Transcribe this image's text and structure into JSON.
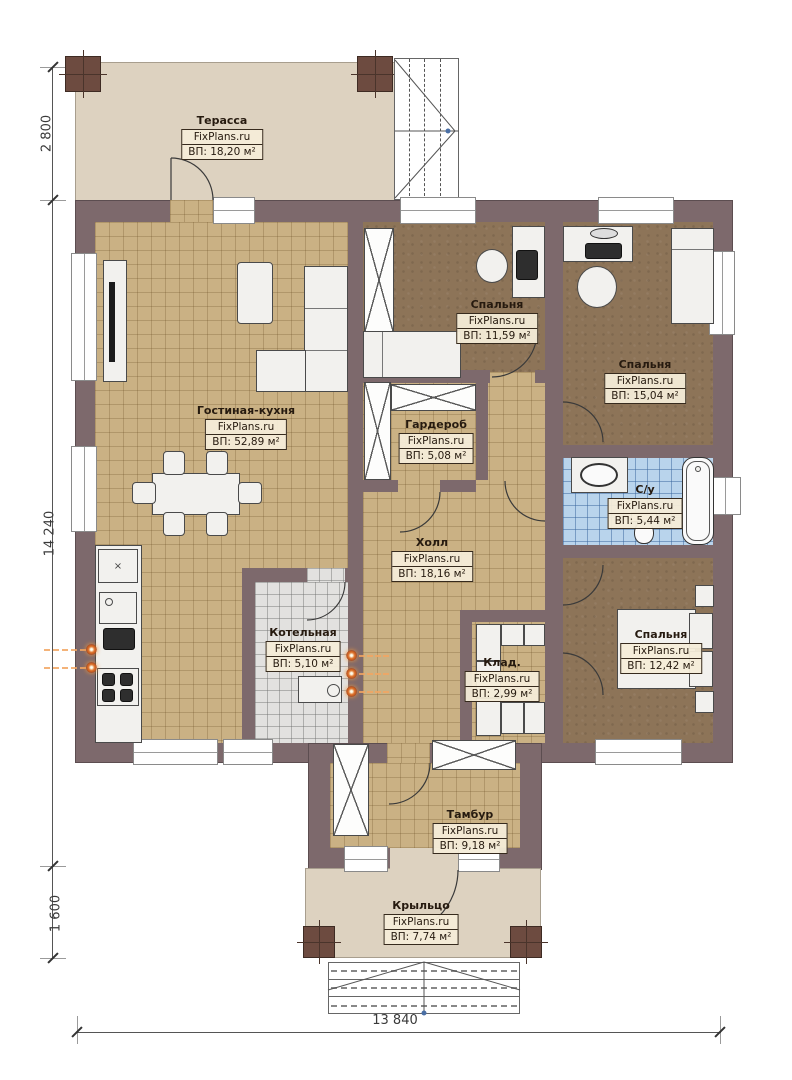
{
  "watermark": "FixPlans.ru",
  "dimensions": {
    "terrace_depth": "2 800",
    "house_depth": "14 240",
    "porch_depth": "1 600",
    "total_width": "13 840"
  },
  "rooms": {
    "terrace": {
      "name": "Терасса",
      "area": "ВП: 18,20 м²"
    },
    "living_kitchen": {
      "name": "Гостиная-кухня",
      "area": "ВП: 52,89 м²"
    },
    "bedroom1": {
      "name": "Спальня",
      "area": "ВП: 11,59 м²"
    },
    "bedroom2": {
      "name": "Спальня",
      "area": "ВП: 15,04 м²"
    },
    "wardrobe": {
      "name": "Гардероб",
      "area": "ВП: 5,08 м²"
    },
    "bathroom": {
      "name": "С/у",
      "area": "ВП: 5,44 м²"
    },
    "hall": {
      "name": "Холл",
      "area": "ВП: 18,16 м²"
    },
    "boiler": {
      "name": "Котельная",
      "area": "ВП: 5,10 м²"
    },
    "storage": {
      "name": "Клад.",
      "area": "ВП: 2,99 м²"
    },
    "bedroom3": {
      "name": "Спальня",
      "area": "ВП: 12,42 м²"
    },
    "vestibule": {
      "name": "Тамбур",
      "area": "ВП: 9,18 м²"
    },
    "porch": {
      "name": "Крыльцо",
      "area": "ВП: 7,74 м²"
    }
  },
  "colors": {
    "wall": "#7d696c",
    "terrace_slab": "#ddd2c0",
    "tile_tan": "#cab184",
    "carpet_brown": "#8d7458",
    "bath_blue": "#b9d4ec",
    "boiler_gray": "#e2e1df",
    "post_brown": "#6d4b40",
    "accent_orange": "#e0762f",
    "label_bg": "#f4ecd8"
  }
}
